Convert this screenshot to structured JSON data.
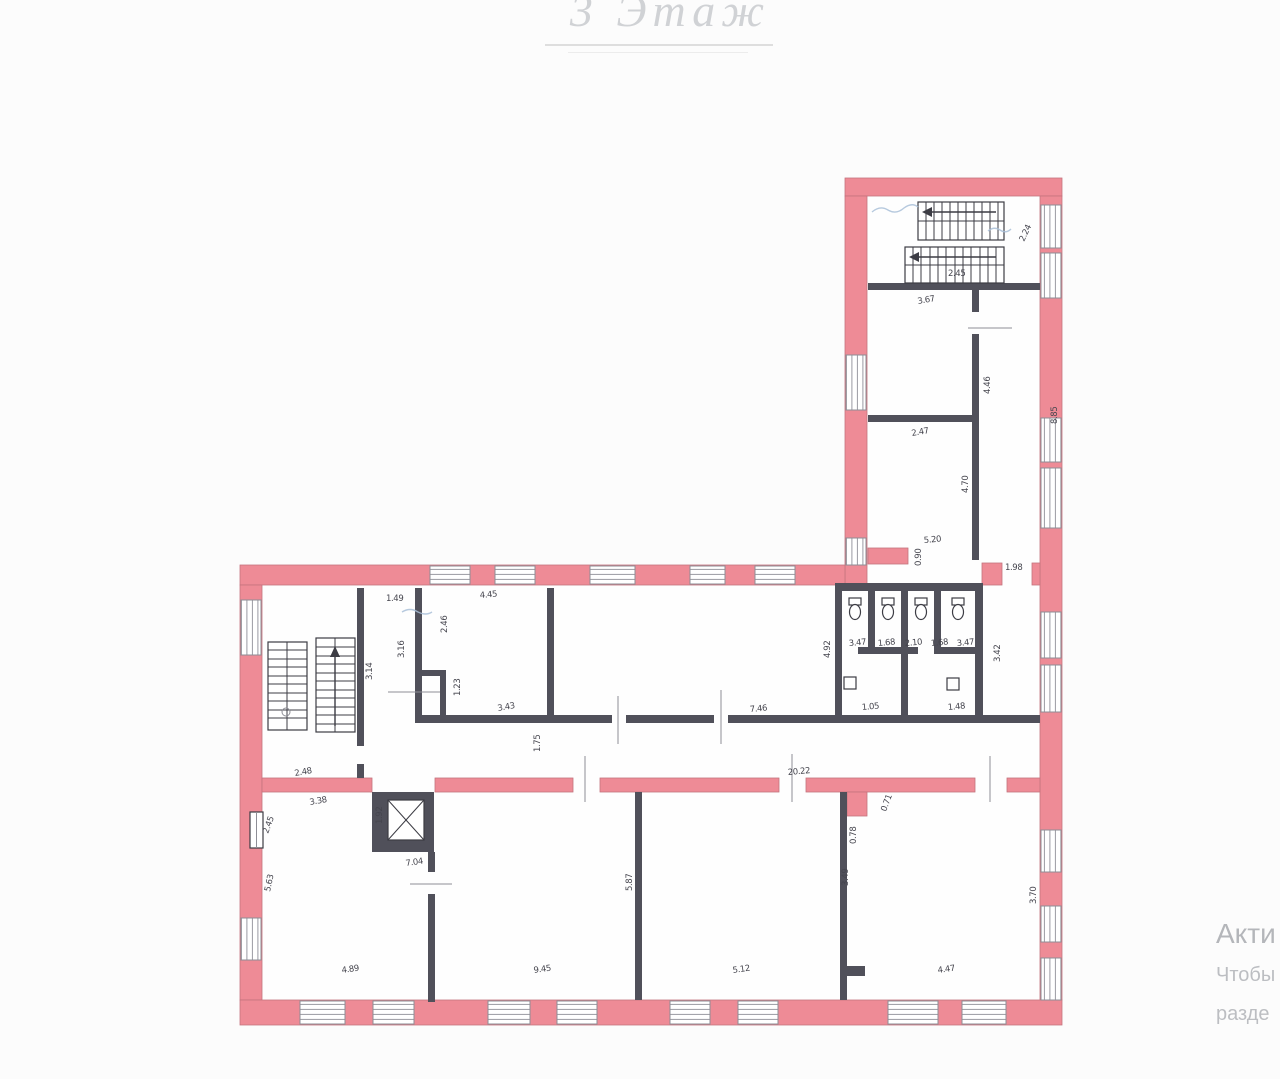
{
  "title": {
    "text": "3 Этаж",
    "color": "#d0d2d5"
  },
  "watermark": {
    "lines": [
      "Акти",
      "Чтобы",
      "разде"
    ],
    "color": "#b4b6ba"
  },
  "plan": {
    "colors": {
      "bg": "#fcfcfc",
      "wall": "#ee8b96",
      "wall_outline": "#c4737e",
      "interior_wall": "#50505a",
      "line": "#8e8e96",
      "annotation_blue": "#a9c0d8",
      "label": "#45454e"
    },
    "dimensions": [
      {
        "text": "2.45",
        "x": 948,
        "y": 276,
        "rot": 0
      },
      {
        "text": "2.24",
        "x": 1024,
        "y": 242,
        "rot": -65
      },
      {
        "text": "3.67",
        "x": 918,
        "y": 304,
        "rot": -10
      },
      {
        "text": "4.46",
        "x": 990,
        "y": 394,
        "rot": -90
      },
      {
        "text": "2.47",
        "x": 912,
        "y": 436,
        "rot": -10
      },
      {
        "text": "4.70",
        "x": 968,
        "y": 493,
        "rot": -90
      },
      {
        "text": "5.20",
        "x": 924,
        "y": 543,
        "rot": -5
      },
      {
        "text": "0.90",
        "x": 921,
        "y": 566,
        "rot": -90
      },
      {
        "text": "1.98",
        "x": 1005,
        "y": 570,
        "rot": 0
      },
      {
        "text": "8.85",
        "x": 1057,
        "y": 424,
        "rot": -90
      },
      {
        "text": "1.49",
        "x": 386,
        "y": 601,
        "rot": 0
      },
      {
        "text": "4.45",
        "x": 480,
        "y": 598,
        "rot": -5
      },
      {
        "text": "2.46",
        "x": 447,
        "y": 633,
        "rot": -90
      },
      {
        "text": "3.16",
        "x": 404,
        "y": 658,
        "rot": -90
      },
      {
        "text": "3.14",
        "x": 372,
        "y": 680,
        "rot": -90
      },
      {
        "text": "1.23",
        "x": 460,
        "y": 696,
        "rot": -90
      },
      {
        "text": "3.43",
        "x": 498,
        "y": 711,
        "rot": -10
      },
      {
        "text": "7.46",
        "x": 750,
        "y": 712,
        "rot": -5
      },
      {
        "text": "2.48",
        "x": 295,
        "y": 776,
        "rot": -10
      },
      {
        "text": "1.75",
        "x": 540,
        "y": 752,
        "rot": -90
      },
      {
        "text": "20.22",
        "x": 788,
        "y": 775,
        "rot": -5
      },
      {
        "text": "4.92",
        "x": 830,
        "y": 658,
        "rot": -90
      },
      {
        "text": "3.47",
        "x": 849,
        "y": 646,
        "rot": -5
      },
      {
        "text": "1.68",
        "x": 878,
        "y": 646,
        "rot": -5
      },
      {
        "text": "2.10",
        "x": 905,
        "y": 646,
        "rot": -5
      },
      {
        "text": "1.68",
        "x": 931,
        "y": 646,
        "rot": -5
      },
      {
        "text": "3.47",
        "x": 957,
        "y": 646,
        "rot": -5
      },
      {
        "text": "1.05",
        "x": 862,
        "y": 710,
        "rot": -5
      },
      {
        "text": "1.48",
        "x": 948,
        "y": 710,
        "rot": -5
      },
      {
        "text": "3.42",
        "x": 1000,
        "y": 662,
        "rot": -90
      },
      {
        "text": "3.38",
        "x": 310,
        "y": 805,
        "rot": -10
      },
      {
        "text": "2.45",
        "x": 268,
        "y": 834,
        "rot": -70
      },
      {
        "text": "5.63",
        "x": 270,
        "y": 892,
        "rot": -78
      },
      {
        "text": "1.92",
        "x": 382,
        "y": 824,
        "rot": -90
      },
      {
        "text": "7.04",
        "x": 406,
        "y": 866,
        "rot": -8
      },
      {
        "text": "4.89",
        "x": 342,
        "y": 973,
        "rot": -8
      },
      {
        "text": "9.45",
        "x": 534,
        "y": 973,
        "rot": -8
      },
      {
        "text": "5.87",
        "x": 632,
        "y": 891,
        "rot": -90
      },
      {
        "text": "5.12",
        "x": 733,
        "y": 973,
        "rot": -8
      },
      {
        "text": "0.71",
        "x": 886,
        "y": 812,
        "rot": -70
      },
      {
        "text": "0.78",
        "x": 856,
        "y": 844,
        "rot": -90
      },
      {
        "text": "3.49",
        "x": 848,
        "y": 886,
        "rot": -90
      },
      {
        "text": "4.47",
        "x": 938,
        "y": 973,
        "rot": -8
      },
      {
        "text": "3.70",
        "x": 1036,
        "y": 904,
        "rot": -90
      }
    ]
  }
}
